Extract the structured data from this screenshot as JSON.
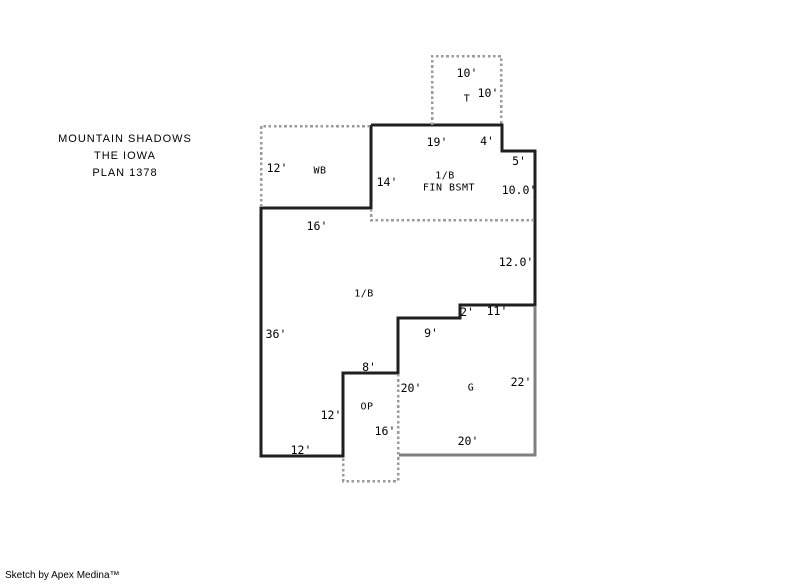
{
  "header": {
    "line1": "MOUNTAIN SHADOWS",
    "line2": "THE IOWA",
    "line3": "PLAN 1378"
  },
  "footer": {
    "credit": "Sketch by Apex Medina™"
  },
  "colors": {
    "background": "#ffffff",
    "wall": "#1f1f1f",
    "dashed": "#9a9a9a",
    "garage": "#808080",
    "text": "#000000"
  },
  "plan": {
    "main_outline": {
      "name": "house-outline-solid",
      "points": [
        [
          371,
          125
        ],
        [
          502,
          125
        ],
        [
          502,
          151
        ],
        [
          535,
          151
        ],
        [
          535,
          305
        ],
        [
          460,
          305
        ],
        [
          460,
          318
        ],
        [
          398,
          318
        ],
        [
          398,
          373
        ],
        [
          343,
          373
        ],
        [
          343,
          456
        ],
        [
          261,
          456
        ],
        [
          261,
          208
        ],
        [
          371,
          208
        ],
        [
          371,
          125
        ]
      ]
    },
    "dashed_polylines": [
      {
        "name": "tub-area-dashed",
        "points": [
          [
            432,
            125
          ],
          [
            432,
            56
          ],
          [
            501,
            56
          ],
          [
            501,
            125
          ]
        ]
      },
      {
        "name": "wb-area-dashed",
        "points": [
          [
            370,
            126
          ],
          [
            261,
            126
          ],
          [
            261,
            207
          ]
        ]
      },
      {
        "name": "fin-bsmt-divider-dashed",
        "points": [
          [
            371,
            209
          ],
          [
            371,
            220
          ],
          [
            534,
            220
          ]
        ]
      },
      {
        "name": "open-porch-dashed",
        "points": [
          [
            398,
            374
          ],
          [
            398,
            481
          ],
          [
            343,
            481
          ],
          [
            343,
            458
          ]
        ]
      }
    ],
    "garage_polylines": [
      {
        "name": "garage-outline-gray",
        "points": [
          [
            535,
            306
          ],
          [
            535,
            455
          ],
          [
            399,
            455
          ]
        ]
      }
    ],
    "labels": [
      {
        "name": "dim-tub-width-10ft",
        "cls": "dim",
        "text": "10'",
        "x": 467,
        "y": 73
      },
      {
        "name": "room-label-tub",
        "cls": "room",
        "text": "T",
        "x": 467,
        "y": 99
      },
      {
        "name": "dim-tub-depth-10ft",
        "cls": "dim",
        "text": "10'",
        "x": 488,
        "y": 93
      },
      {
        "name": "dim-19ft",
        "cls": "dim",
        "text": "19'",
        "x": 437,
        "y": 142
      },
      {
        "name": "dim-4ft",
        "cls": "dim",
        "text": "4'",
        "x": 487,
        "y": 141
      },
      {
        "name": "dim-5ft",
        "cls": "dim",
        "text": "5'",
        "x": 519,
        "y": 161
      },
      {
        "name": "dim-wb-12ft",
        "cls": "dim",
        "text": "12'",
        "x": 277,
        "y": 168
      },
      {
        "name": "room-label-wb",
        "cls": "room",
        "text": "WB",
        "x": 320,
        "y": 171
      },
      {
        "name": "dim-14ft",
        "cls": "dim",
        "text": "14'",
        "x": 387,
        "y": 182
      },
      {
        "name": "room-label-bsmt-1b",
        "cls": "room",
        "text": "1/B",
        "x": 445,
        "y": 176
      },
      {
        "name": "room-label-fin-bsmt",
        "cls": "room",
        "text": "FIN BSMT",
        "x": 449,
        "y": 188
      },
      {
        "name": "dim-10-0ft",
        "cls": "dim",
        "text": "10.0'",
        "x": 519,
        "y": 190
      },
      {
        "name": "dim-16ft-top",
        "cls": "dim",
        "text": "16'",
        "x": 317,
        "y": 226
      },
      {
        "name": "dim-12-0ft",
        "cls": "dim",
        "text": "12.0'",
        "x": 516,
        "y": 262
      },
      {
        "name": "room-label-main-1b",
        "cls": "room",
        "text": "1/B",
        "x": 364,
        "y": 294
      },
      {
        "name": "dim-2ft",
        "cls": "dim",
        "text": "2'",
        "x": 467,
        "y": 312
      },
      {
        "name": "dim-11ft",
        "cls": "dim",
        "text": "11'",
        "x": 497,
        "y": 311
      },
      {
        "name": "dim-9ft",
        "cls": "dim",
        "text": "9'",
        "x": 431,
        "y": 333
      },
      {
        "name": "dim-36ft",
        "cls": "dim",
        "text": "36'",
        "x": 276,
        "y": 334
      },
      {
        "name": "dim-8ft",
        "cls": "dim",
        "text": "8'",
        "x": 369,
        "y": 367
      },
      {
        "name": "dim-garage-20ft-left",
        "cls": "dim",
        "text": "20'",
        "x": 411,
        "y": 388
      },
      {
        "name": "room-label-garage",
        "cls": "room",
        "text": "G",
        "x": 471,
        "y": 388
      },
      {
        "name": "dim-22ft",
        "cls": "dim",
        "text": "22'",
        "x": 521,
        "y": 382
      },
      {
        "name": "dim-op-12ft",
        "cls": "dim",
        "text": "12'",
        "x": 331,
        "y": 415
      },
      {
        "name": "room-label-op",
        "cls": "room",
        "text": "OP",
        "x": 367,
        "y": 407
      },
      {
        "name": "dim-op-16ft",
        "cls": "dim",
        "text": "16'",
        "x": 385,
        "y": 431
      },
      {
        "name": "dim-12ft-bottom",
        "cls": "dim",
        "text": "12'",
        "x": 301,
        "y": 450
      },
      {
        "name": "dim-20ft-bottom",
        "cls": "dim",
        "text": "20'",
        "x": 468,
        "y": 441
      }
    ]
  }
}
